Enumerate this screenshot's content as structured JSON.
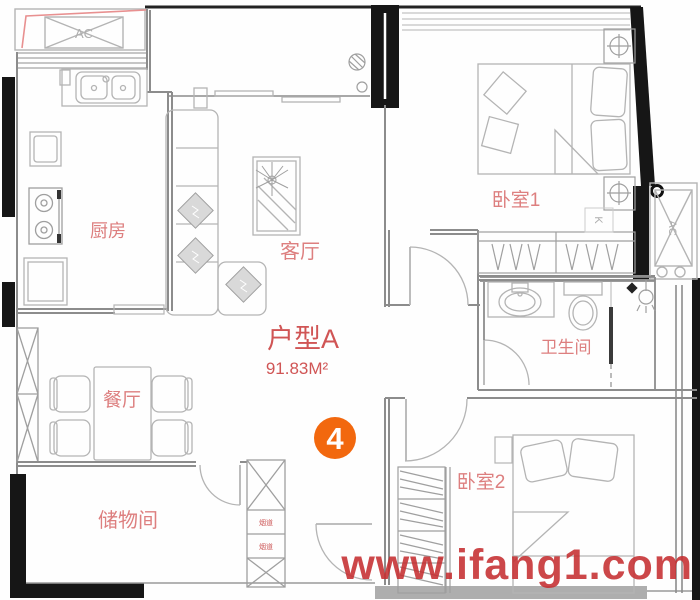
{
  "unit": {
    "name": "户型A",
    "area": "91.83M²",
    "badge_number": "4"
  },
  "rooms": {
    "kitchen": "厨房",
    "living": "客厅",
    "dining": "餐厅",
    "storage": "储物间",
    "bedroom1": "卧室1",
    "bathroom": "卫生间",
    "bedroom2": "卧室2"
  },
  "annotations": {
    "ac_top": "AC",
    "ac_right": "AC",
    "k": "K",
    "duct_top": "烟道",
    "duct_bottom": "烟道"
  },
  "watermark": {
    "text": "www.ifang1.com"
  },
  "colors": {
    "room_label_red": "#dd7f7f",
    "title_red": "#d05555",
    "watermark_red": "#c52d30",
    "badge_orange": "#f2680e",
    "wall_black": "#161616",
    "wall_gray": "#8c8c8c",
    "furniture_gray": "#b4b4b4",
    "guide_line_pink": "#e89090"
  }
}
